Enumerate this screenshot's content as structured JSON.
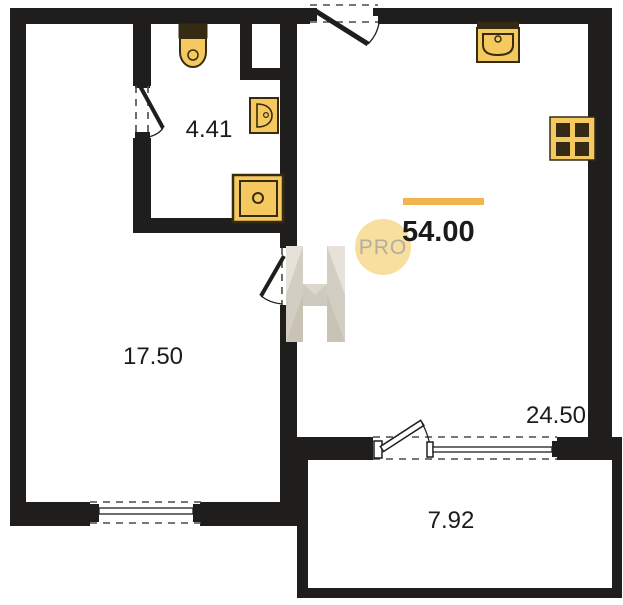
{
  "rooms": [
    {
      "name": "bathroom",
      "area": "4.41"
    },
    {
      "name": "room",
      "area": "17.50"
    },
    {
      "name": "kitchen-living-room",
      "area": "24.50"
    },
    {
      "name": "balcony",
      "area": "7.92"
    }
  ],
  "total": {
    "area": "54.00"
  },
  "watermark": {
    "text": "PRO"
  },
  "icons": {
    "bathroom": [
      "toilet-icon",
      "washbasin-icon",
      "shower-tray-icon"
    ],
    "kitchen": [
      "kitchen-sink-icon",
      "stove-icon"
    ]
  },
  "colors": {
    "wall": "#201e1c",
    "fixture_fill": "#f6c860",
    "fixture_stroke": "#362c10",
    "fixture_dark": "#352b15",
    "accent_bar": "#f1b54f",
    "watermark_circle": "#f8dfa0",
    "watermark_text": "#b3ada2",
    "label": "#1b1b1b",
    "dash": "#4a4a4a"
  }
}
